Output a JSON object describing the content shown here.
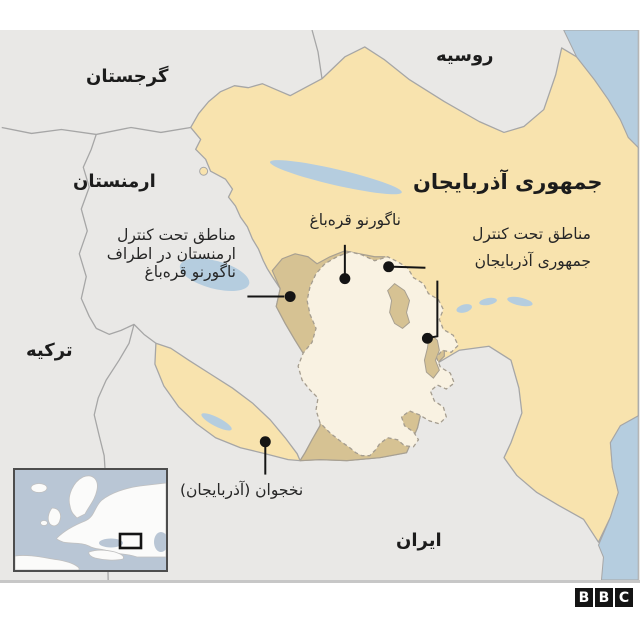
{
  "map": {
    "colors": {
      "land_gray": "#e9e8e6",
      "azerbaijan_yellow": "#f8e3ae",
      "armenian_controlled_tan": "#d6c293",
      "nagorno_karabakh_cream": "#f9f2e2",
      "water_blue": "#b5cddf",
      "border_gray": "#a6a6a6",
      "callout_black": "#141414",
      "label_text": "#1c1c1c"
    },
    "country_labels": {
      "russia": "روسیه",
      "georgia": "گرجستان",
      "armenia": "ارمنستان",
      "azerbaijan": "جمهوری آذربایجان",
      "turkey": "ترکیه",
      "iran": "ایران"
    },
    "callouts": {
      "nagorno_karabakh": {
        "text": "ناگورنو قره‌باغ"
      },
      "armenian_control": {
        "lines": [
          "مناطق تحت کنترل",
          "ارمنستان در اطراف",
          "ناگورنو قره‌باغ"
        ]
      },
      "azerbaijan_control": {
        "lines": [
          "مناطق تحت کنترل",
          "جمهوری آذربایجان"
        ]
      },
      "nakhchivan": {
        "text": "نخجوان (آذربایجان)"
      }
    }
  },
  "footer": {
    "logo_letters": [
      "B",
      "B",
      "C"
    ]
  }
}
